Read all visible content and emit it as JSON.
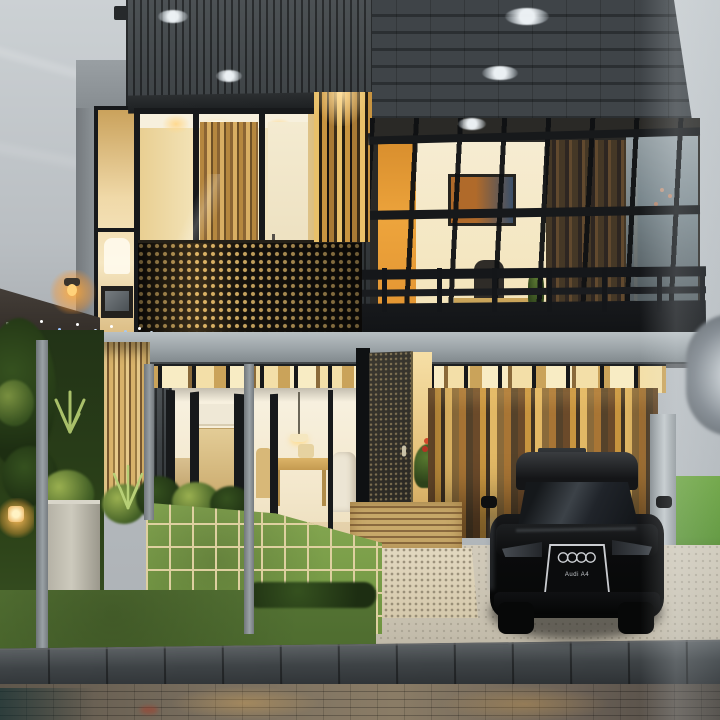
{
  "scene": {
    "description": "Night-lit architectural scale model of a modern two-story house in a glass display: dark slat facade, shingled roof, warm lit interiors, perforated balcony screen, miniature garden, grass-grid terrace and a black model car in the carport"
  },
  "car": {
    "make_badge": "audi-rings",
    "grille_text": "Audi A4"
  },
  "palette": {
    "frame": "#17191b",
    "slat": "#3c4144",
    "slatDark": "#2b2f32",
    "slatLight": "#4c5154",
    "roofA": "#3f4448",
    "roofB": "#2b2f32",
    "warmA": "#f6e3ae",
    "warmB": "#caa25c",
    "amber": "#e9b24b",
    "orange": "#e0912f",
    "woodA": "#c8953f",
    "woodB": "#6b4a2a",
    "woodC": "#e2b865",
    "woodD": "#3f3222",
    "woodE": "#8a6a3a",
    "dotGold": "#d9b368",
    "fasciaA": "#b9c0c3",
    "fasciaB": "#7e868a",
    "paver": "#6f9440",
    "paverLine": "#ded0a0",
    "lawn": "#4e6c2f",
    "shrubDark": "#3f5c24",
    "shrubLight": "#9ab050",
    "stone": "#d5c9ac",
    "drive": "#c6bfae",
    "curbA": "#5a5f62",
    "curbB": "#2e3235",
    "street": "#6b6157",
    "streetGlow": "#c8a05a",
    "carBody": "#0a0b0c",
    "chrome": "#caccd0",
    "glow": "#ffd98f",
    "grassBack": "#5a9433",
    "bgTop": "#c6cbce",
    "bgLow": "#a9aeb2"
  }
}
